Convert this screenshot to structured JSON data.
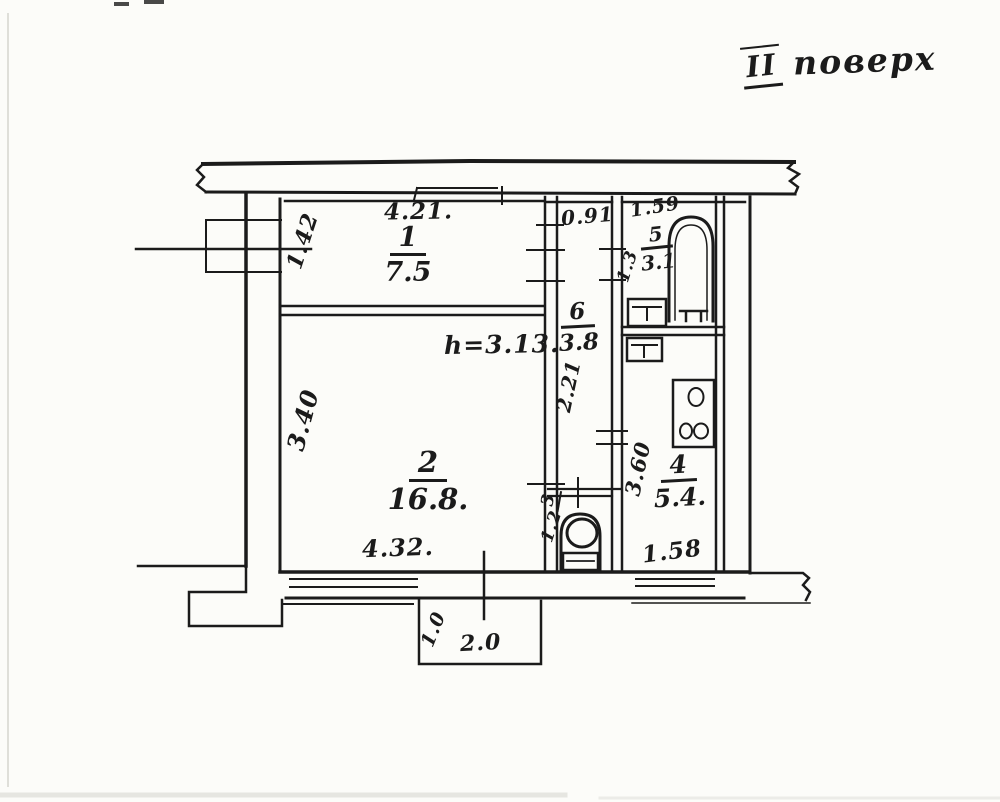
{
  "drawing": {
    "floor_label": {
      "numeral": "II",
      "word": "поверх"
    },
    "ceiling_height": "h=3.13.",
    "rooms": [
      {
        "number": "1",
        "area": "7.5"
      },
      {
        "number": "2",
        "area": "16.8."
      },
      {
        "number": "3",
        "area": "1.2"
      },
      {
        "number": "4",
        "area": "5.4."
      },
      {
        "number": "5",
        "area": "3.1"
      },
      {
        "number": "6",
        "area": "3.8"
      }
    ],
    "dims": {
      "room1_width": "4.21.",
      "room1_depth": "1.42",
      "room2_depth": "3.40",
      "room2_width": "4.32.",
      "hall_width": "0.91",
      "hall_depth": "2.21",
      "bath_width": "1.59",
      "bath_depth": "1.3",
      "kitchen_depth": "3.60",
      "kitchen_width": "1.58",
      "balcony_depth": "1.0",
      "balcony_width": "2.0"
    }
  }
}
